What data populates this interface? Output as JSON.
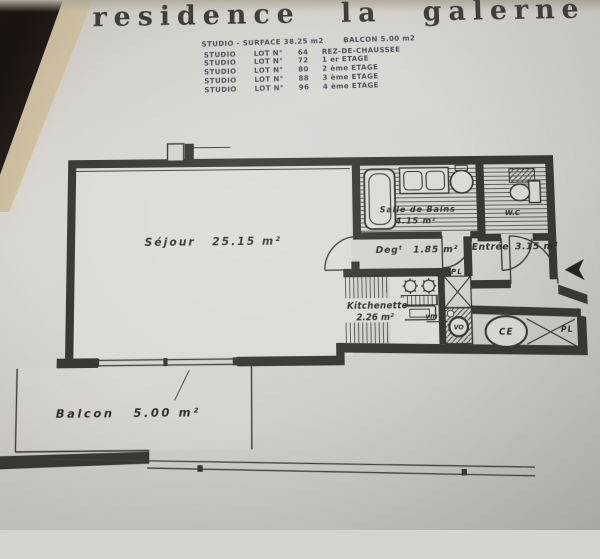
{
  "title": "residence la galerne",
  "summary": {
    "surface_label": "STUDIO - SURFACE 38.25 m2",
    "balcon_label": "BALCON 5.00 m2"
  },
  "lots": [
    {
      "type": "STUDIO",
      "lot": "LOT N°",
      "num": "64",
      "floor": "REZ-DE-CHAUSSEE"
    },
    {
      "type": "STUDIO",
      "lot": "LOT N°",
      "num": "72",
      "floor": "1 er ETAGE"
    },
    {
      "type": "STUDIO",
      "lot": "LOT N°",
      "num": "80",
      "floor": "2 ème ETAGE"
    },
    {
      "type": "STUDIO",
      "lot": "LOT N°",
      "num": "88",
      "floor": "3 ème ETAGE"
    },
    {
      "type": "STUDIO",
      "lot": "LOT N°",
      "num": "96",
      "floor": "4 ème ETAGE"
    }
  ],
  "plan": {
    "sejour": {
      "name": "Séjour",
      "area": "25.15 m²"
    },
    "salle_de_bains": {
      "name": "Salle de Bains",
      "area": "4.15 m²"
    },
    "wc": {
      "name": "W.C"
    },
    "degagement": {
      "name": "Degᵗ",
      "area": "1.85 m²"
    },
    "entree": {
      "name": "Entrée",
      "area": "3.15 m²"
    },
    "kitchenette": {
      "name": "Kitchenette",
      "area": "2.26 m²"
    },
    "balcon": {
      "name": "Balcon",
      "area": "5.00 m²"
    },
    "placard_top": "PL",
    "placard_right": "PL",
    "chauffe_eau": "CE",
    "vide_ordures": "VO",
    "ventilation": "vm"
  },
  "colors": {
    "paper": "#d6d3cf",
    "backdrop": "#19130f",
    "page_edge": "#eadfca",
    "title_ink": "#413f3c",
    "table_ink": "#4e4e58",
    "plan_ink": "#3a3833"
  }
}
